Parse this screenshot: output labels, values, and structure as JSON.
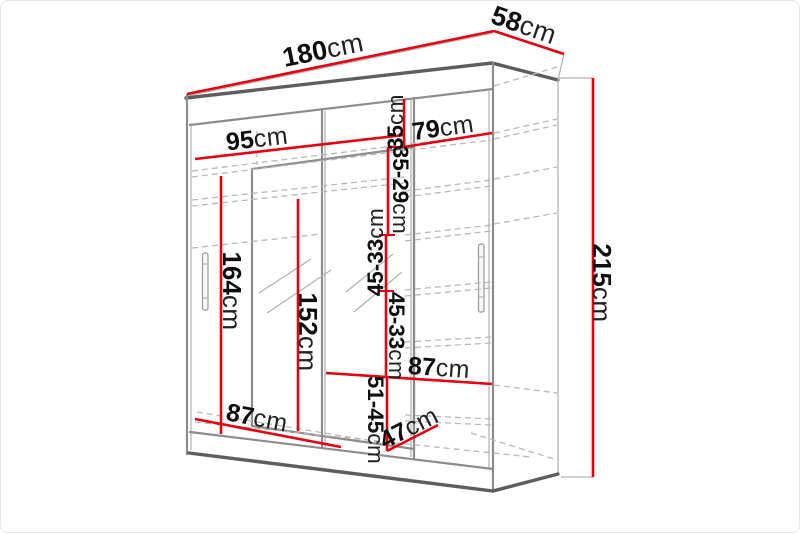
{
  "diagram": {
    "unit": "cm",
    "dimensions": {
      "total_width": {
        "value": "180",
        "unit": "cm"
      },
      "total_depth": {
        "value": "58",
        "unit": "cm"
      },
      "total_height": {
        "value": "215",
        "unit": "cm"
      },
      "left_section_width": {
        "value": "95",
        "unit": "cm"
      },
      "right_section_width": {
        "value": "79",
        "unit": "cm"
      },
      "top_shelf_gap": {
        "value": "35",
        "unit": "cm"
      },
      "upper_shelf_gap": {
        "value": "35-29",
        "unit": "cm"
      },
      "middle_shelf_gap_upper": {
        "value": "45-33",
        "unit": "cm"
      },
      "middle_shelf_gap_lower": {
        "value": "45-33",
        "unit": "cm"
      },
      "bottom_shelf_gap": {
        "value": "51-45",
        "unit": "cm"
      },
      "left_bottom_width": {
        "value": "87",
        "unit": "cm"
      },
      "right_shelf_width": {
        "value": "87",
        "unit": "cm"
      },
      "bottom_depth": {
        "value": "47",
        "unit": "cm"
      },
      "left_door_height": {
        "value": "164",
        "unit": "cm"
      },
      "mirror_height": {
        "value": "152",
        "unit": "cm"
      }
    },
    "colors": {
      "dimension_line": "#e50010",
      "outline": "#8c8c8c",
      "hidden_line": "#b9b9b9",
      "text": "#0e0e0e"
    }
  }
}
